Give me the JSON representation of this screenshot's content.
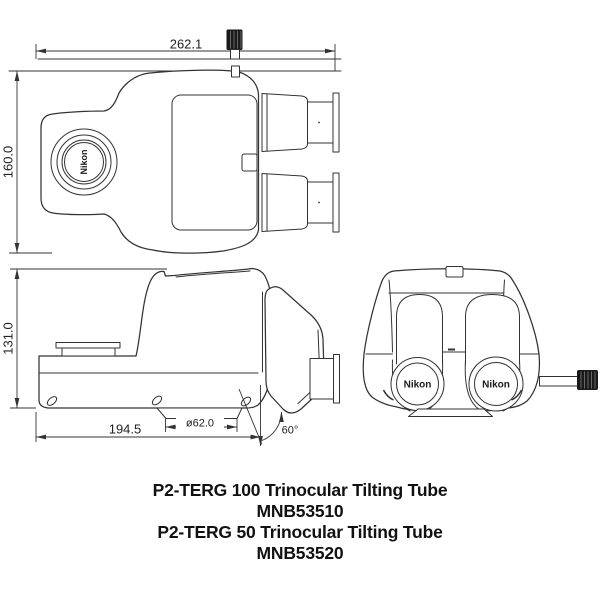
{
  "drawing": {
    "brand_label": "Nikon",
    "views": {
      "top": {
        "width_mm": "262.1",
        "height_mm": "160.0"
      },
      "side": {
        "height_mm": "131.0",
        "depth_mm": "194.5",
        "port_diameter_mm": "ø62.0",
        "tilt_angle": "60°"
      }
    }
  },
  "products": [
    {
      "name": "P2-TERG 100 Trinocular Tilting Tube",
      "code": "MNB53510"
    },
    {
      "name": "P2-TERG 50 Trinocular Tilting Tube",
      "code": "MNB53520"
    }
  ],
  "colors": {
    "line": "#333333",
    "text": "#111111",
    "screw": "#1a1a1a",
    "background": "#ffffff"
  }
}
